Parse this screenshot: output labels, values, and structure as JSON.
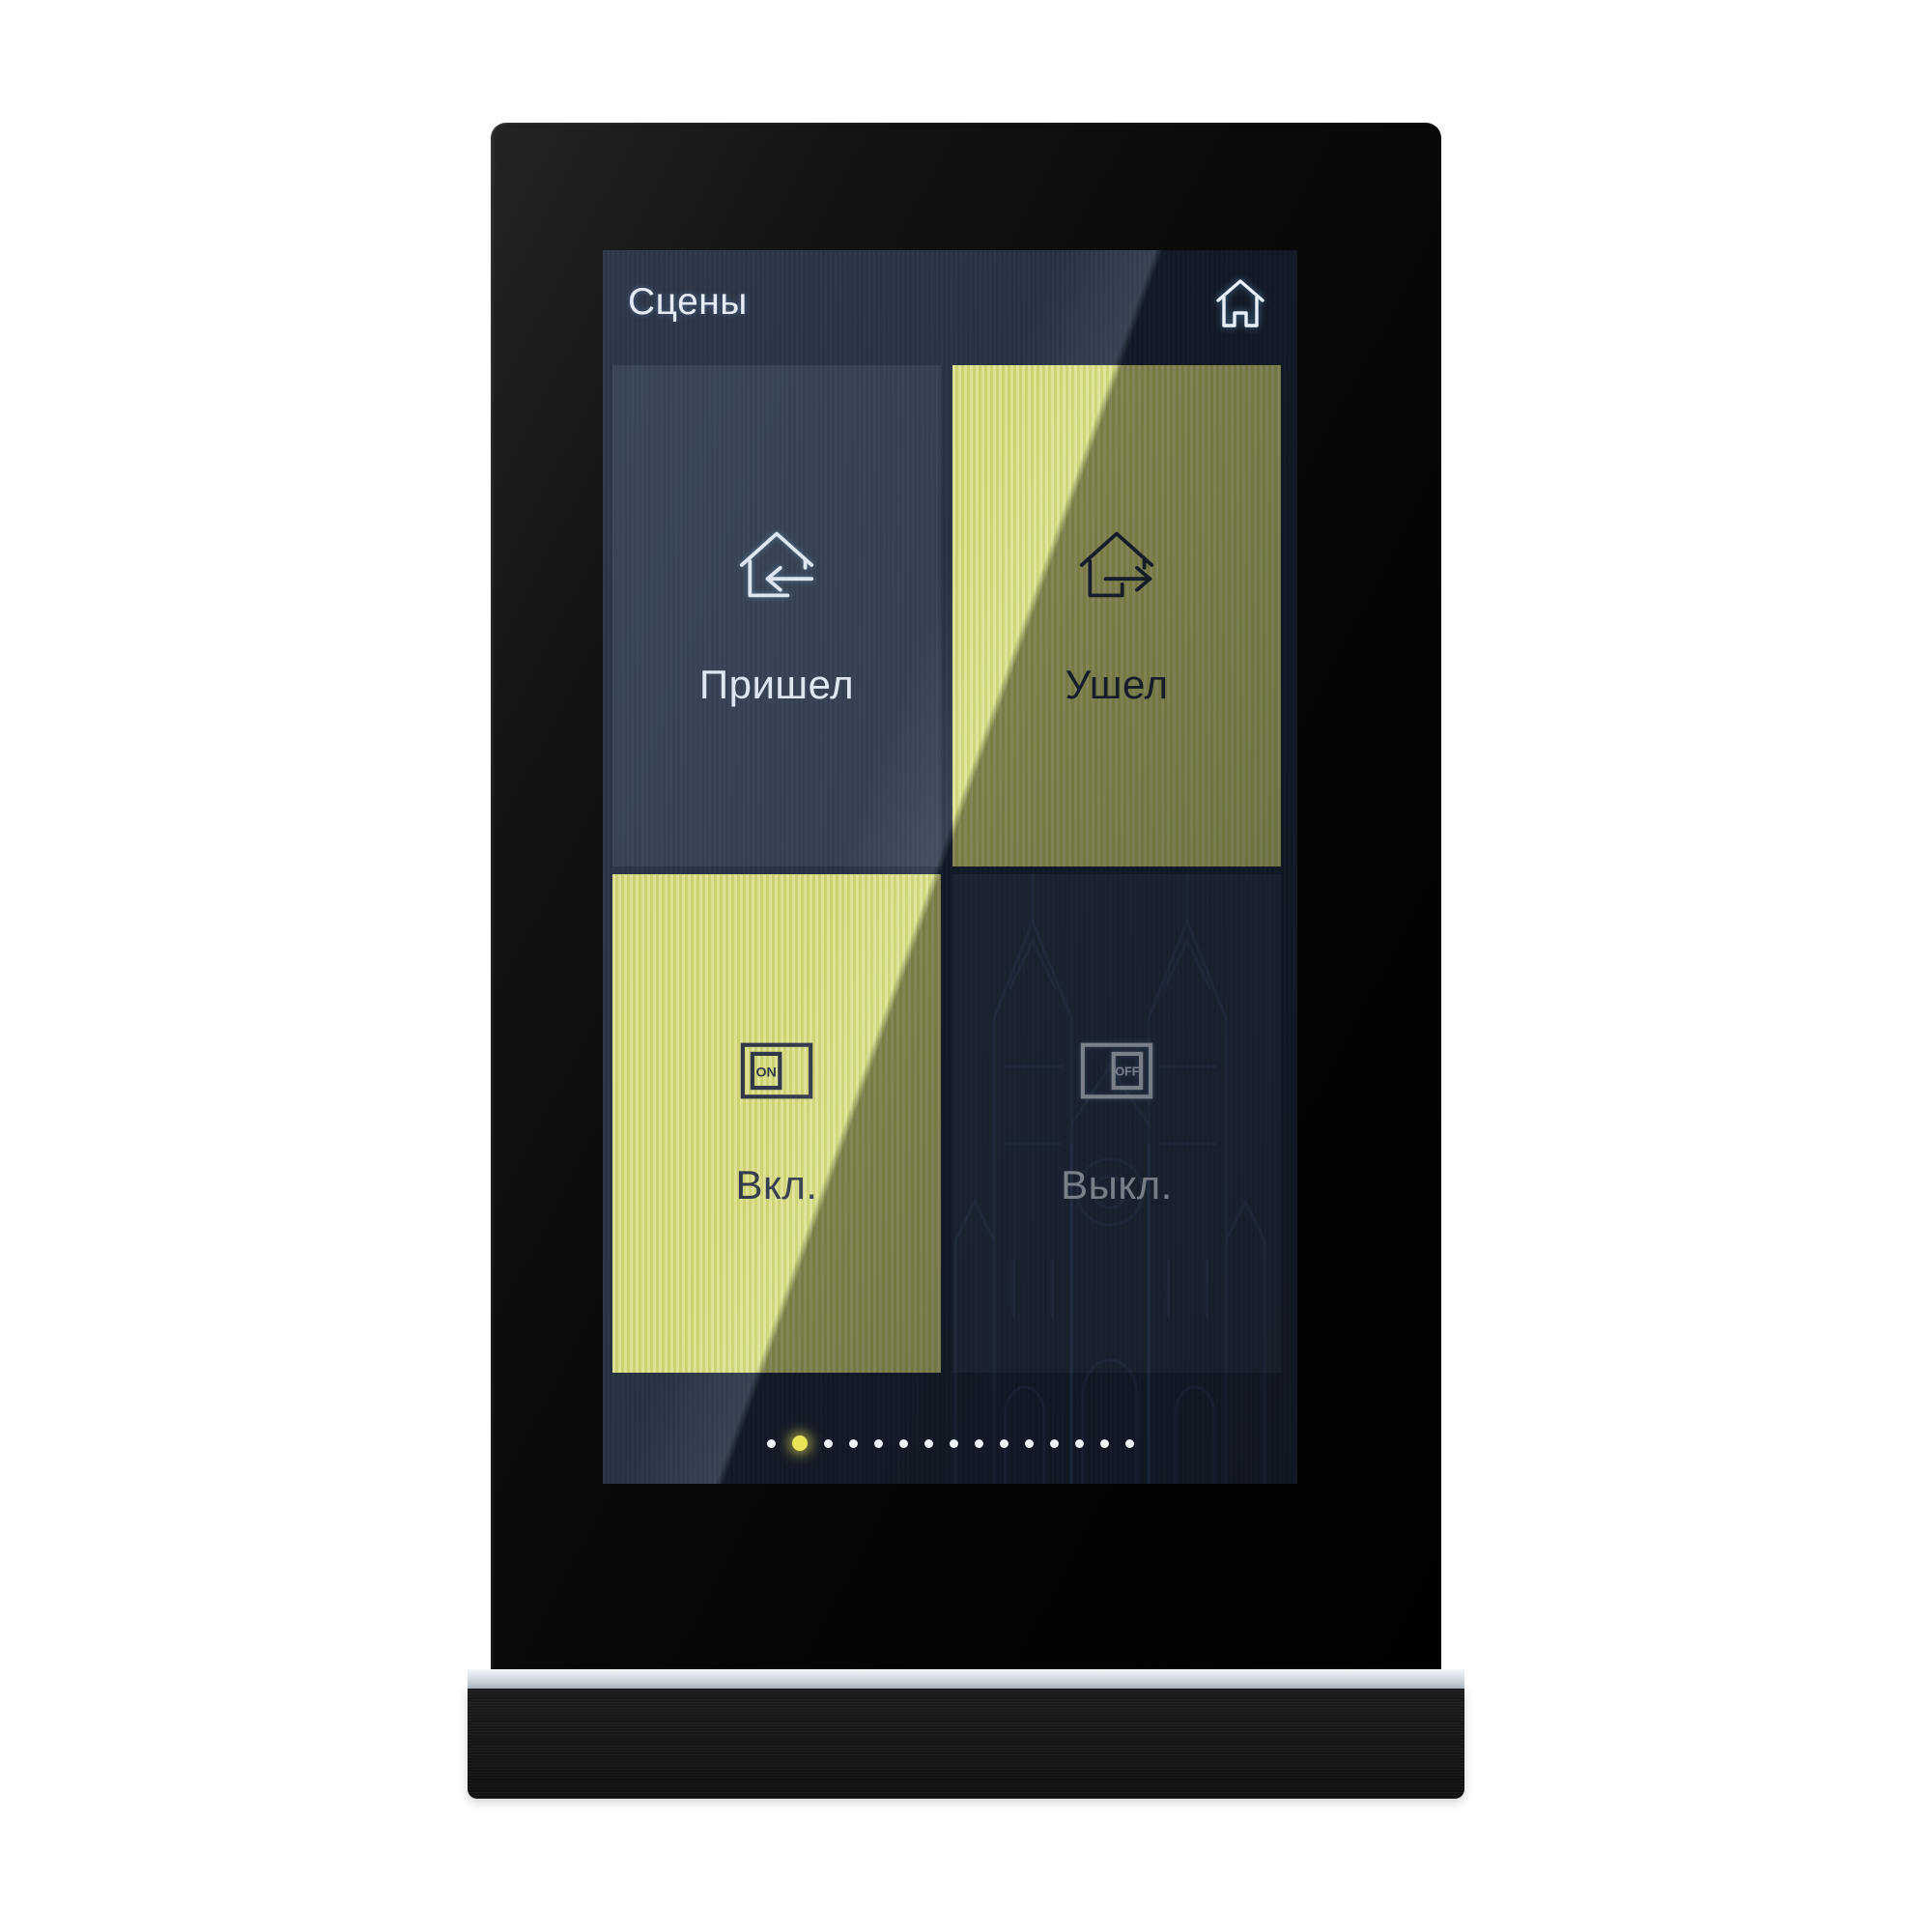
{
  "panel": {
    "screen_title": "Сцены",
    "nav": {
      "home_icon": "home"
    },
    "tiles": [
      {
        "label": "Пришел",
        "state": "inactive",
        "icon": "house-arrow-in"
      },
      {
        "label": "Ушел",
        "state": "active",
        "icon": "house-arrow-out"
      },
      {
        "label": "Вкл.",
        "state": "active",
        "icon": "switch-on",
        "icon_text": "ON"
      },
      {
        "label": "Выкл.",
        "state": "inactive",
        "icon": "switch-off",
        "icon_text": "OFF"
      }
    ],
    "pagination": {
      "dot_count": 15,
      "active_index": 1
    },
    "colors": {
      "screen_bg": "#1e2737",
      "tile_active_yellow": "#d7db6e",
      "text_on_dark": "#e1e9f3",
      "text_on_yellow": "#272e3f",
      "dot_inactive": "#eef3f8",
      "dot_active": "#e9e557",
      "accent_strip": "#d6dde3"
    }
  }
}
